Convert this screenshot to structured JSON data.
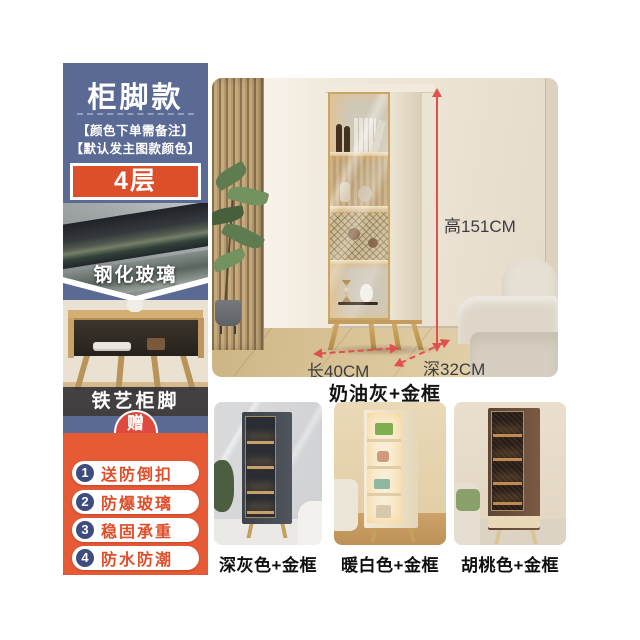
{
  "sidebar": {
    "title": "柜脚款",
    "note_line1": "【颜色下单需备注】",
    "note_line2": "【默认发主图款颜色】",
    "layers_badge": "4层",
    "glass_label": "钢化玻璃",
    "feet_label": "铁艺柜脚",
    "gift_badge": "赠",
    "gift_items": [
      {
        "num": "1",
        "text": "送防倒扣"
      },
      {
        "num": "2",
        "text": "防爆玻璃"
      },
      {
        "num": "3",
        "text": "稳固承重"
      },
      {
        "num": "4",
        "text": "防水防潮"
      }
    ]
  },
  "main": {
    "dim_height": "高151CM",
    "dim_length": "长40CM",
    "dim_depth": "深32CM",
    "caption": "奶油灰+金框"
  },
  "variants": [
    {
      "label": "深灰色+金框"
    },
    {
      "label": "暖白色+金框"
    },
    {
      "label": "胡桃色+金框"
    }
  ],
  "colors": {
    "sidebar_blue": "#5b6a95",
    "badge_orange": "#dd4e2b",
    "gift_panel_orange": "#e65a36",
    "gift_arch_red": "#df4a3e",
    "number_circle_navy": "#3e4d7d",
    "pill_text_orange": "#e04e2a",
    "dimension_arrow_red": "#e0504e",
    "gold_frame": "#c7a666"
  }
}
